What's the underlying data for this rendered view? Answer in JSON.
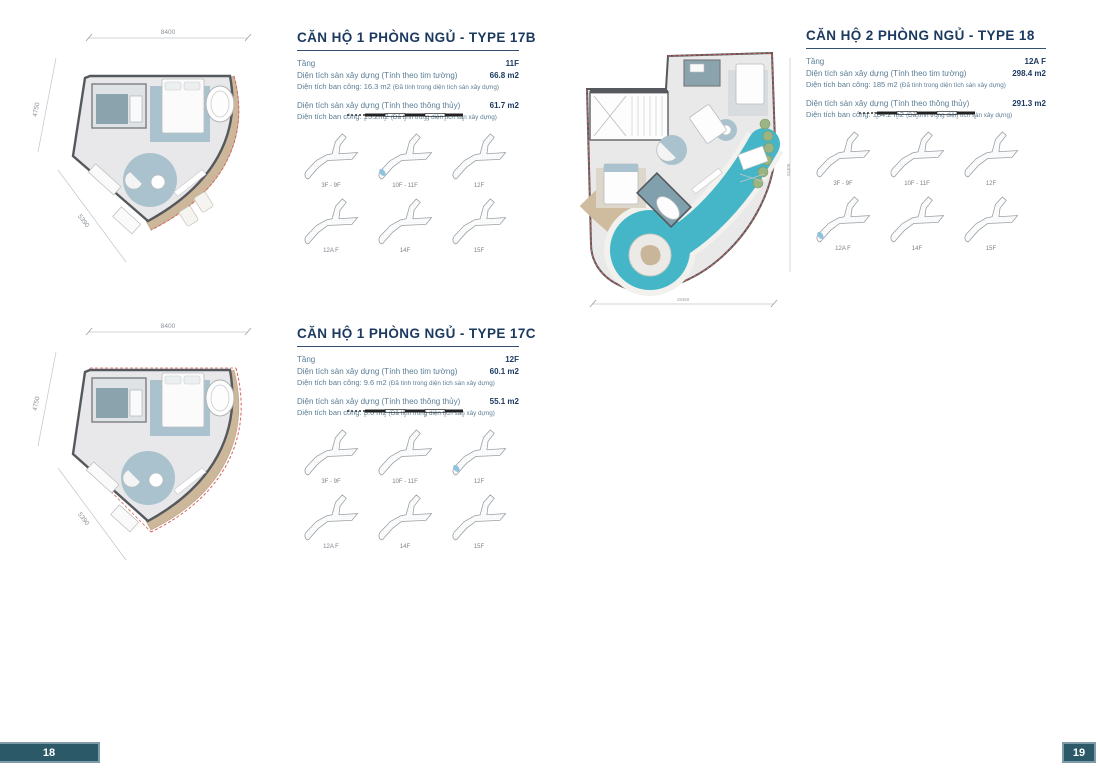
{
  "colors": {
    "accent_navy": "#1c3a60",
    "label_blue": "#5a7d94",
    "tab_background": "#2b5968",
    "pool_teal": "#44b6c8",
    "balcony_wood": "#ccb79b",
    "keyplan_highlight": "#8ec3e0",
    "outline_red": "#d8625a"
  },
  "scalebar_ticks": [
    "0",
    "1",
    "2",
    "3",
    "4",
    "5"
  ],
  "keyplan_labels": [
    "3F - 9F",
    "10F - 11F",
    "12F",
    "12A F",
    "14F",
    "15F"
  ],
  "keyplan_highlight_index": {
    "kp17b": 1,
    "kp18": 3,
    "kp17c": 2
  },
  "sections": {
    "type17b": {
      "title": "CĂN HỘ 1 PHÒNG NGỦ - TYPE 17B",
      "floor_label": "Tầng",
      "floor_value": "11F",
      "area1_label": "Diện tích sàn xây dựng (Tính theo tim tường)",
      "area1_value": "66.8 m2",
      "balcony1": "Diện tích ban công: 16.3 m2",
      "balcony1_note": "(Đã tính trong diện tích sàn xây dựng)",
      "area2_label": "Diện tích sàn xây dựng (Tính theo thông thủy)",
      "area2_value": "61.7 m2",
      "balcony2": "Diện tích ban công: 15.2m2",
      "balcony2_note": "(Đã tính trong diện tích sàn xây dựng)",
      "dims": {
        "top": "8400",
        "left": "4750",
        "diagonal": "5390"
      }
    },
    "type18": {
      "title": "CĂN HỘ 2 PHÒNG NGỦ - TYPE 18",
      "floor_label": "Tầng",
      "floor_value": "12A F",
      "area1_label": "Diện tích sàn xây dựng (Tính theo tim tường)",
      "area1_value": "298.4 m2",
      "balcony1": "Diện tích ban công: 185 m2",
      "balcony1_note": "(Đã tính trong diện tích sàn xây dựng)",
      "area2_label": "Diện tích sàn xây dựng (Tính theo thông thủy)",
      "area2_value": "291.3 m2",
      "balcony2": "Diện tích ban công: 184.2 m2",
      "balcony2_note": "(Đã tính trong diện tích sàn xây dựng)",
      "dims": {
        "bottom": "19450",
        "right": "24400"
      }
    },
    "type17c": {
      "title": "CĂN HỘ 1 PHÒNG NGỦ - TYPE 17C",
      "floor_label": "Tầng",
      "floor_value": "12F",
      "area1_label": "Diện tích sàn xây dựng (Tính theo tim tường)",
      "area1_value": "60.1 m2",
      "balcony1": "Diện tích ban công: 9.6 m2",
      "balcony1_note": "(Đã tính trong diện tích sàn xây dựng)",
      "area2_label": "Diện tích sàn xây dựng (Tính theo thông thủy)",
      "area2_value": "55.1 m2",
      "balcony2": "Diện tích ban công: 8.6 m2",
      "balcony2_note": "(Đã tính trong diện tích sàn xây dựng)",
      "dims": {
        "top": "8400",
        "left": "4750",
        "diagonal": "5390"
      }
    }
  },
  "page_numbers": {
    "left": "18",
    "right": "19"
  }
}
